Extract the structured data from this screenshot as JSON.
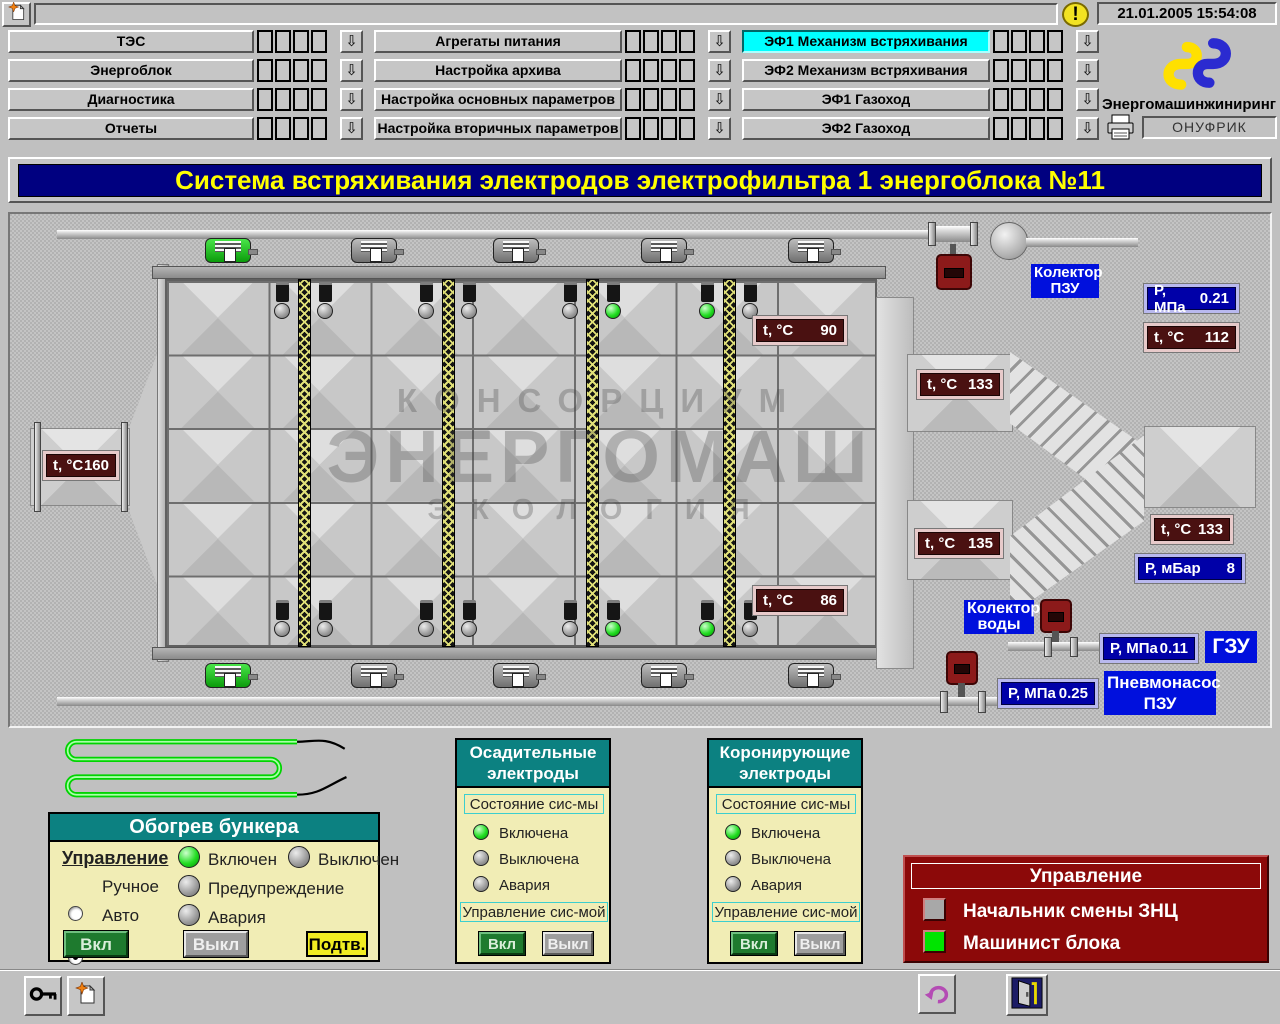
{
  "topbar": {
    "status_value": "",
    "datetime": "21.01.2005 15:54:08"
  },
  "branding": {
    "company": "Энергомашинжиниринг",
    "operator": "ОНУФРИК"
  },
  "menu": {
    "col1": [
      "ТЭС",
      "Энергоблок",
      "Диагностика",
      "Отчеты"
    ],
    "col2": [
      "Агрегаты питания",
      "Настройка архива",
      "Настройка основных параметров",
      "Настройка вторичных параметров"
    ],
    "col3": [
      "ЭФ1 Механизм встряхивания",
      "ЭФ2 Механизм встряхивания",
      "ЭФ1 Газоход",
      "ЭФ2 Газоход"
    ],
    "active_item": "ЭФ1 Механизм встряхивания"
  },
  "title_banner": "Система встряхивания электродов электрофильтра 1 энергоблока №11",
  "diagram": {
    "watermark": {
      "line1": "КОНСОРЦИУМ",
      "line2": "ЭНЕРГОМАШ",
      "line3": "ЭКОЛОГИЯ"
    },
    "labels": {
      "collector_pzu_line1": "Колектор",
      "collector_pzu_line2": "ПЗУ",
      "collector_water_line1": "Колектор",
      "collector_water_line2": "воды",
      "gzu": "ГЗУ",
      "pneumopump_line1": "Пневмонасос",
      "pneumopump_line2": "ПЗУ"
    },
    "readouts": {
      "t_inlet": {
        "label": "t, °C",
        "value": "160"
      },
      "t_field_top": {
        "label": "t, °C",
        "value": "90"
      },
      "t_field_bottom": {
        "label": "t, °C",
        "value": "86"
      },
      "p_collector_pzu": {
        "label": "Р, МПа",
        "value": "0.21"
      },
      "t_collector_pzu": {
        "label": "t, °C",
        "value": "112"
      },
      "t_outlet_top": {
        "label": "t, °C",
        "value": "133"
      },
      "t_outlet_bottom": {
        "label": "t, °C",
        "value": "135"
      },
      "t_stack": {
        "label": "t, °C",
        "value": "133"
      },
      "p_stack": {
        "label": "Р, мБар",
        "value": "8"
      },
      "p_water": {
        "label": "Р, МПа",
        "value": "0.11"
      },
      "p_pneumopump": {
        "label": "Р, МПа",
        "value": "0.25"
      }
    }
  },
  "bunker_panel": {
    "title": "Обогрев бункера",
    "control_label": "Управление",
    "mode_manual": "Ручное",
    "mode_auto": "Авто",
    "selected_mode": "Авто",
    "lamp_on": "Включен",
    "lamp_off": "Выключен",
    "lamp_warning": "Предупреждение",
    "lamp_alarm": "Авария",
    "active_lamp": "Включен",
    "btn_on": "Вкл",
    "btn_off": "Выкл",
    "btn_confirm": "Подтв."
  },
  "precip_panel": {
    "title_line1": "Осадительные",
    "title_line2": "электроды",
    "status_label": "Состояние сис-мы",
    "lamp_on": "Включена",
    "lamp_off": "Выключена",
    "lamp_alarm": "Авария",
    "active_lamp": "Включена",
    "control_label": "Управление сис-мой",
    "btn_on": "Вкл",
    "btn_off": "Выкл"
  },
  "corona_panel": {
    "title_line1": "Коронирующие",
    "title_line2": "электроды",
    "status_label": "Состояние сис-мы",
    "lamp_on": "Включена",
    "lamp_off": "Выключена",
    "lamp_alarm": "Авария",
    "active_lamp": "Включена",
    "control_label": "Управление сис-мой",
    "btn_on": "Вкл",
    "btn_off": "Выкл"
  },
  "operators_panel": {
    "title": "Управление",
    "row1": "Начальник смены ЗНЦ",
    "row2": "Машинист блока",
    "active_row": "Машинист блока"
  },
  "colors": {
    "active_menu_bg": "#00ffff",
    "title_bg": "#000080",
    "title_text": "#ffff00",
    "lamp_on": "#22dd22",
    "lamp_off": "#9a9a9a",
    "panel_header_bg": "#0c8181",
    "panel_body_bg": "#f1edb5",
    "operators_panel_bg": "#8c0909",
    "blue_label_bg": "#0010dd",
    "readout_temp_bg": "#4a1111",
    "readout_pressure_bg": "#0000a8"
  }
}
